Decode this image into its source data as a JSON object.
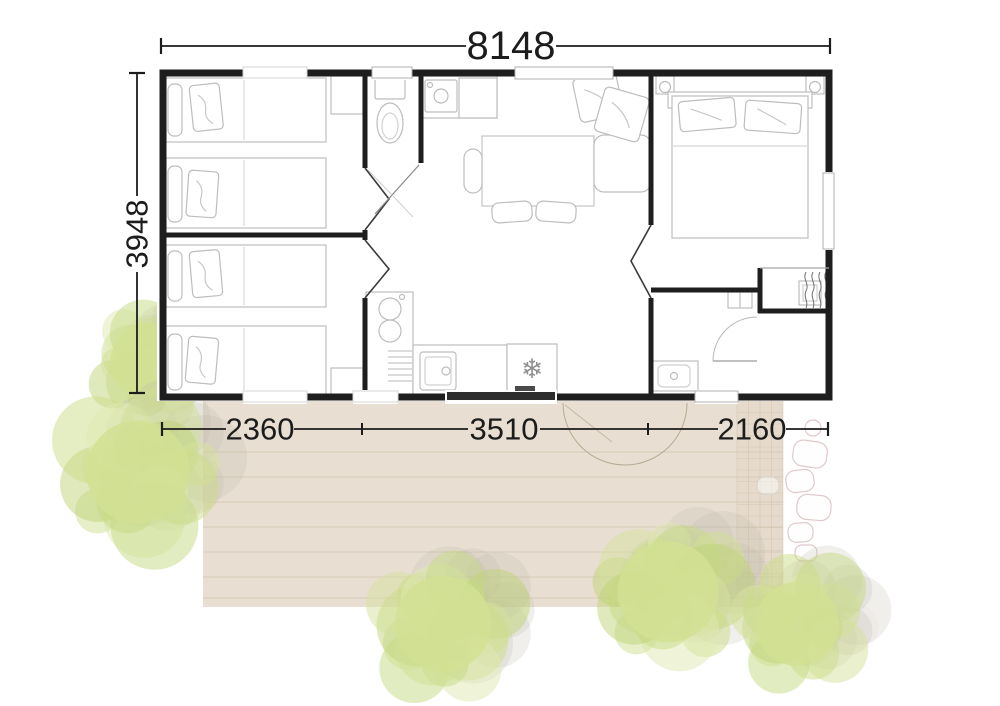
{
  "dimensions": {
    "total_width": "8148",
    "total_depth": "3948",
    "bottom_segments": [
      {
        "label": "2360"
      },
      {
        "label": "3510"
      },
      {
        "label": "2160"
      }
    ]
  },
  "icons": {
    "fridge_snowflake": "❄"
  },
  "colors": {
    "wall": "#1e1e1e",
    "furniture_line": "#bdbdbd",
    "dimension_line": "#1c1c1c",
    "terrace_fill": "#e8dfd2",
    "terrace_plank_line": "#d3c5b2",
    "tree_green": "#d2e094",
    "tree_shadow": "#b9b4a8",
    "stone_outline": "#e0c9c9",
    "entrance_threshold": "#2d2d2d"
  },
  "decor": {
    "shadow_offset": {
      "dx": 30,
      "dy": -14
    },
    "trees": [
      {
        "cx": 150,
        "cy": 362,
        "r": 66,
        "seed": 1
      },
      {
        "cx": 138,
        "cy": 472,
        "r": 86,
        "seed": 2
      },
      {
        "cx": 443,
        "cy": 624,
        "r": 80,
        "seed": 3
      },
      {
        "cx": 668,
        "cy": 592,
        "r": 84,
        "seed": 4
      },
      {
        "cx": 797,
        "cy": 624,
        "r": 70,
        "seed": 5
      }
    ]
  }
}
